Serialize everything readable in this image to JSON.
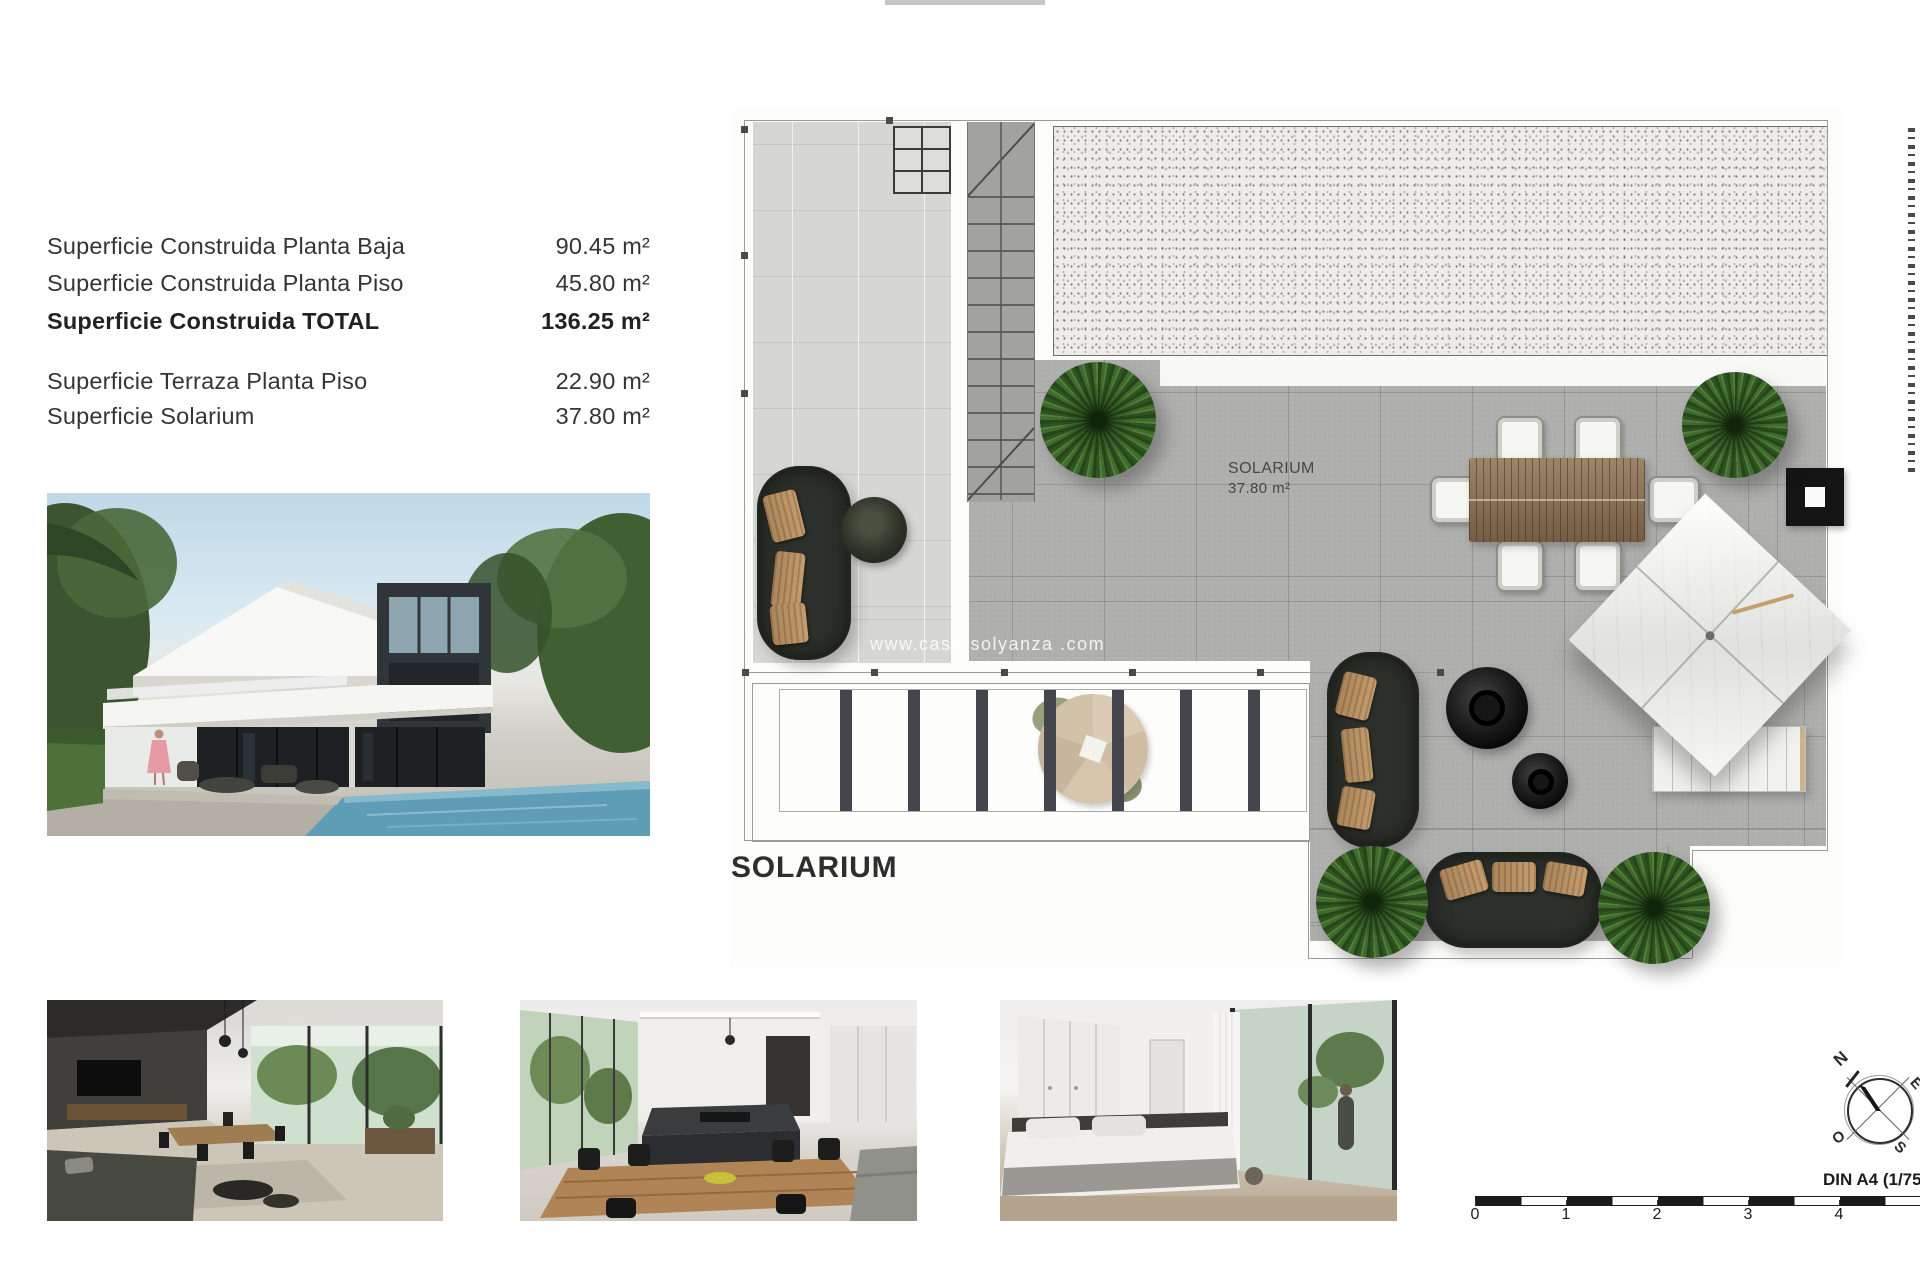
{
  "specs": {
    "rows": [
      {
        "label": "Superficie Construida Planta Baja",
        "value": "90.45 m²"
      },
      {
        "label": "Superficie Construida Planta Piso",
        "value": "45.80 m²"
      },
      {
        "label": "Superficie Construida TOTAL",
        "value": "136.25 m²"
      },
      {
        "label": "Superficie Terraza Planta Piso",
        "value": "22.90 m²"
      },
      {
        "label": "Superficie Solarium",
        "value": "37.80 m²"
      }
    ]
  },
  "plan": {
    "room_label": {
      "name": "SOLARIUM",
      "area": "37.80 m²"
    },
    "watermark": "www.casa-solyanza .com"
  },
  "section_title": "SOLARIUM",
  "compass": {
    "n": "N",
    "e": "E",
    "s": "S",
    "o": "O"
  },
  "scale_bar": {
    "caption": "DIN A4 (1/75",
    "ticks": [
      "0",
      "1",
      "2",
      "3",
      "4"
    ]
  },
  "colors": {
    "ink": "#383838",
    "terrace_gray": "#aeaeac",
    "tile_gray": "#d6d6d4",
    "gravel": "#edece9",
    "plant_green": "#3f6b2f",
    "sofa_dark": "#2d302a",
    "pillow_tan": "#b28d63",
    "wood": "#8d7150"
  }
}
